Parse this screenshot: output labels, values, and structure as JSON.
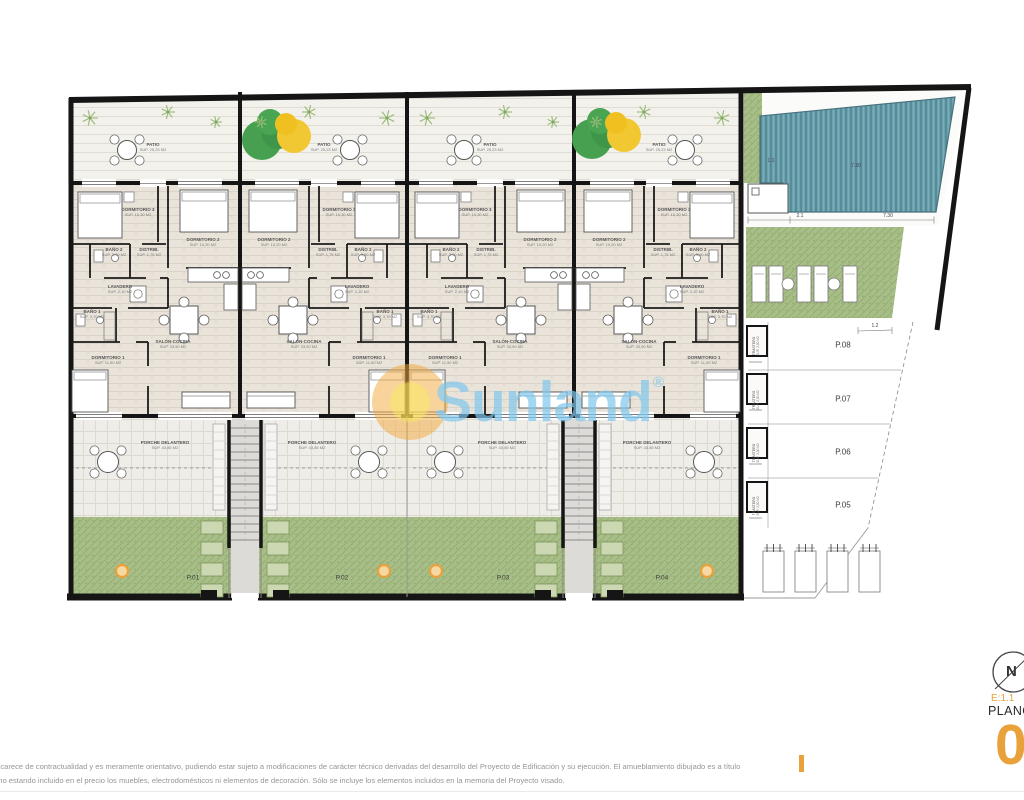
{
  "watermark": {
    "brand": "Sunland",
    "registered_mark": "®"
  },
  "disclaimer": {
    "line1": "o carece de contractualidad y es meramente orientativo, pudiendo estar sujeto a modificaciones de carácter técnico derivadas del desarrollo del Proyecto de Edificación y su ejecución. El amueblamiento dibujado es a título",
    "line2": ", no estando incluido en el precio los muebles, electrodomésticos ni elementos de decoración. Sólo se incluye los elementos incluidos en la memoria del Proyecto visado."
  },
  "title_block": {
    "scale": "E:1.1",
    "plano_label": "PLANO",
    "sheet_number": "0",
    "north_letter": "N"
  },
  "plan": {
    "units": [
      {
        "id": "P.01",
        "mirrored": false
      },
      {
        "id": "P.02",
        "mirrored": true
      },
      {
        "id": "P.03",
        "mirrored": false
      },
      {
        "id": "P.04",
        "mirrored": true
      }
    ],
    "rooms": {
      "patio": {
        "name": "PATIO",
        "sup": "SUP. 25,23 M2"
      },
      "dorm3": {
        "name": "DORMITORIO 3",
        "sup": "SUP. 10,30 M2"
      },
      "dorm2": {
        "name": "DORMITORIO 2",
        "sup": "SUP. 10,20 M2"
      },
      "bano2": {
        "name": "BAÑO 2",
        "sup": "SUP. 3,90 M2"
      },
      "distrib": {
        "name": "DISTRIB.",
        "sup": "SUP. 1,75 M2"
      },
      "lavadero": {
        "name": "LAVADERO",
        "sup": "SUP. 2,10 M2"
      },
      "bano1": {
        "name": "BAÑO 1",
        "sup": "SUP. 3,70 M2"
      },
      "dorm1": {
        "name": "DORMITORIO 1",
        "sup": "SUP. 11,90 M2"
      },
      "salon": {
        "name": "SALÓN-COCINA",
        "sup": "SUP. 33,90 M2"
      },
      "porche": {
        "name": "PORCHE DELANTERO",
        "sup": "SUP. 43,85 M2"
      }
    },
    "parking": {
      "spaces": [
        "P.08",
        "P.07",
        "P.06",
        "P.05"
      ],
      "trastero": {
        "name": "TRASTERO",
        "sup": "SUP. 2,00 M2"
      }
    },
    "dimensions": [
      "7.30",
      "1.1",
      "2.1",
      "7.30",
      "1.2"
    ],
    "colors": {
      "accent_orange": "#E9A13B",
      "watermark_blue": "#80C7EC",
      "pool_teal": "#6BA2B0",
      "grass_green": "#A8BE88"
    }
  }
}
